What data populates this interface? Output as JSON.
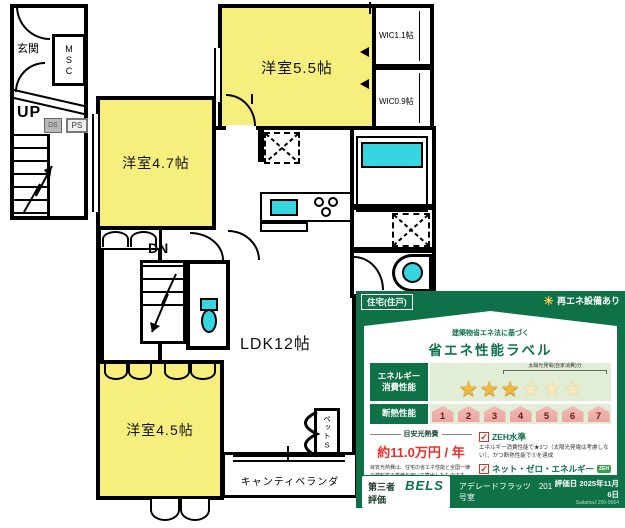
{
  "icons": {
    "star": "★",
    "check": "✓",
    "sun": "☀"
  },
  "floor_plan": {
    "rooms": {
      "genkan": "玄関",
      "msc": "MSC",
      "up": "UP",
      "ds": "DS",
      "ps": "PS",
      "bedroom_5_5": "洋室5.5帖",
      "wic_1_1": "WIC1.1帖",
      "wic_0_9": "WIC0.9帖",
      "bedroom_4_7": "洋室4.7帖",
      "dn": "DN",
      "ldk": "LDK12帖",
      "bedroom_4_5": "洋室4.5帖",
      "balcony": "キャンティベランダ",
      "pet_space": "ペットS"
    },
    "colors": {
      "wall": "#000000",
      "room_fill": "#f7ef7d",
      "fixture": "#35d6e0"
    }
  },
  "energy_label": {
    "type_tag": "住宅(住戸)",
    "renewable_note": "再エネ設備あり",
    "law_text": "建築物省エネ法に基づく",
    "title": "省エネ性能ラベル",
    "energy_performance": {
      "label_line1": "エネルギー",
      "label_line2": "消費性能",
      "stars_filled": 3,
      "stars_solar": 3,
      "solar_note": "太陽光発電(自家消費)分"
    },
    "insulation": {
      "label": "断熱性能",
      "levels": [
        "1",
        "2",
        "3",
        "4",
        "5",
        "6",
        "7"
      ]
    },
    "cost": {
      "heading": "目安光熱費",
      "value": "約11.0万円 / 年",
      "note": "目安光熱費は、住宅の省エネ性能と全国一律の燃料等の単価を用いて算出したものです。実際の光熱費は、使用条件や設備、契約会社・方法などにより異なります。"
    },
    "zeh": {
      "title": "ZEH水準",
      "text": "エネルギー消費性能で★3つ（太陽光発電は考慮しない）、かつ断熱性能で⑤を達成"
    },
    "net_zero": {
      "title": "ネット・ゼロ・エネルギー",
      "badge": "ZEH",
      "text": "太陽光発電の売電分も含めてエネルギー収支がゼロ以下を達成"
    },
    "footer": {
      "evaluator_label": "第三者評価",
      "evaluator": "BELS",
      "property": "アデレードフラッツ　201号室",
      "date": "評価日 2025年11月6日",
      "cert_no": "SaitamaJ 200-9064"
    },
    "colors": {
      "green": "#0f7148",
      "star": "#f1ba3e",
      "house_badge": "#eba5a0",
      "price_red": "#e8302a"
    }
  }
}
